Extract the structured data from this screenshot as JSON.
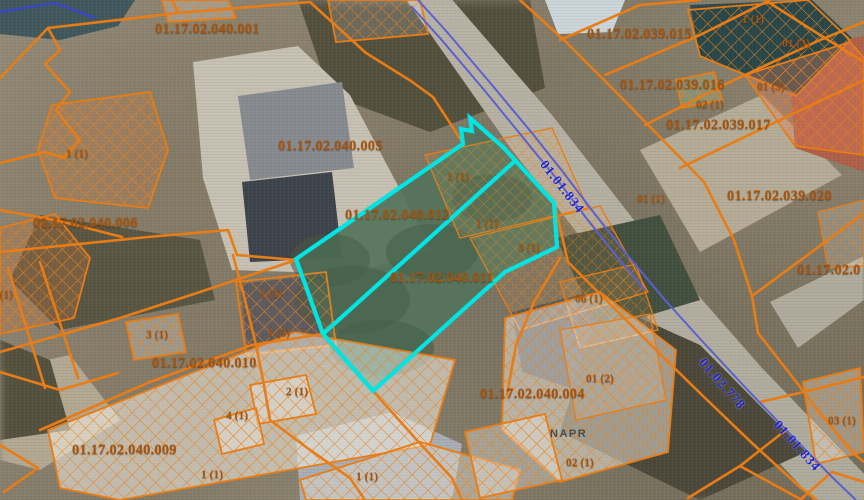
{
  "map": {
    "colors": {
      "parcel_line": "#e87c15",
      "parcel_label": "#a5540e",
      "highlight": "#00e4e4",
      "road_line": "#5c60cf",
      "road_label": "#2326c8"
    },
    "parcel_labels": [
      {
        "text": "01.17.02.040.001",
        "x": 155,
        "y": 21
      },
      {
        "text": "01.17.02.039.015",
        "x": 587,
        "y": 26
      },
      {
        "text": "01.17.02.039.016",
        "x": 620,
        "y": 77
      },
      {
        "text": "01.17.02.039.017",
        "x": 666,
        "y": 117
      },
      {
        "text": "01.17.02.040.005",
        "x": 278,
        "y": 138
      },
      {
        "text": "01.17.02.039.020",
        "x": 727,
        "y": 188
      },
      {
        "text": "01.17.02.040.006",
        "x": 33,
        "y": 215
      },
      {
        "text": "01.17.02.040.012",
        "x": 345,
        "y": 207
      },
      {
        "text": "01.17.02.0",
        "x": 797,
        "y": 262
      },
      {
        "text": "01.17.02.040.011",
        "x": 390,
        "y": 270
      },
      {
        "text": "01.17.02.040.010",
        "x": 152,
        "y": 355
      },
      {
        "text": "01.17.02.040.009",
        "x": 72,
        "y": 442
      },
      {
        "text": "01.17.02.040.004",
        "x": 480,
        "y": 386
      }
    ],
    "unit_labels": [
      {
        "text": "1 (1)",
        "x": 742,
        "y": 14
      },
      {
        "text": "01 (3)",
        "x": 782,
        "y": 38
      },
      {
        "text": "01 (3)",
        "x": 757,
        "y": 81
      },
      {
        "text": "02 (1)",
        "x": 696,
        "y": 99
      },
      {
        "text": "1 (1)",
        "x": 66,
        "y": 148
      },
      {
        "text": "1 (1)",
        "x": 447,
        "y": 171
      },
      {
        "text": "01 (1)",
        "x": 637,
        "y": 193
      },
      {
        "text": "1 (1)",
        "x": 476,
        "y": 218
      },
      {
        "text": "3 (1)",
        "x": 518,
        "y": 242
      },
      {
        "text": "1 (1)",
        "x": -9,
        "y": 289
      },
      {
        "text": "1 (1)",
        "x": 260,
        "y": 288
      },
      {
        "text": "06 (1)",
        "x": 575,
        "y": 293
      },
      {
        "text": "3 (1)",
        "x": 146,
        "y": 329
      },
      {
        "text": "1 (1)",
        "x": 268,
        "y": 327
      },
      {
        "text": "01 (2)",
        "x": 586,
        "y": 373
      },
      {
        "text": "2 (1)",
        "x": 286,
        "y": 386
      },
      {
        "text": "4 (1)",
        "x": 226,
        "y": 410
      },
      {
        "text": "03 (1)",
        "x": 828,
        "y": 415
      },
      {
        "text": "02 (1)",
        "x": 566,
        "y": 457
      },
      {
        "text": "1 (1)",
        "x": 201,
        "y": 469
      },
      {
        "text": "1 (1)",
        "x": 356,
        "y": 471
      }
    ],
    "road_labels": [
      {
        "text": "01.01.834",
        "x": 562,
        "y": 187,
        "angle": 52
      },
      {
        "text": "01.02.778",
        "x": 722,
        "y": 384,
        "angle": 49
      },
      {
        "text": "01.01.834",
        "x": 797,
        "y": 446,
        "angle": 48
      }
    ],
    "street_label": {
      "text": "NAPR",
      "x": 550,
      "y": 428
    }
  },
  "geometry": {
    "highlight": {
      "outer": "470,118 472,131 461,129 463,144 296,259 323,334 373,391 505,272 557,247 554,203 503,147",
      "divider": "516,160 323,334"
    },
    "vegetation": "470,118 472,131 461,129 463,144 296,259 323,334 373,391 505,272 557,247 554,203 503,147",
    "veg_blobs": [
      [
        352,
        300,
        58,
        34
      ],
      [
        432,
        252,
        46,
        28
      ],
      [
        492,
        198,
        40,
        24
      ],
      [
        382,
        348,
        52,
        28
      ],
      [
        330,
        260,
        40,
        26
      ]
    ],
    "orange_lines": [
      "0,78 48,28 178,13 310,2 366,53 411,81 433,97 463,143",
      "48,28 60,50 45,64 70,92 56,110 80,140 64,158 45,152",
      "0,163 45,152",
      "178,13 172,0",
      "0,252 148,237 228,230 237,255 296,260",
      "0,210 60,221 122,237",
      "296,260 200,292 120,318 0,352",
      "40,430 150,382 252,345 323,334",
      "233,255 245,300 256,345 264,385 270,420",
      "0,372 60,390 118,373",
      "8,268 45,388",
      "40,262 78,378",
      "373,391 415,438 452,478 462,500",
      "270,420 310,450 350,478 365,500",
      "560,258 534,302 516,345 507,395",
      "556,210 568,262 612,306 657,351 703,396 753,444 801,488 817,500",
      "520,0 566,42 612,88 658,135 704,182 734,240 752,296 758,333 787,370 820,413 853,453 864,462",
      "560,40 640,5 700,0",
      "605,75 700,35 770,0",
      "645,125 730,82 820,40 864,22",
      "680,168 780,120 864,80",
      "752,296 863,214",
      "760,402 808,391 864,377",
      "688,498 740,466 802,500",
      "740,466 786,430",
      "765,0 820,35 864,62",
      "800,500 832,472 864,482",
      "0,445 38,468 4,492"
    ],
    "buildings": [
      {
        "pts": "52,105 150,92 168,150 148,208 55,198 38,150",
        "tint": "rgba(205,130,70,0.28)"
      },
      {
        "pts": "162,0 228,0 236,18 168,22",
        "tint": "rgba(255,255,255,0.2)"
      },
      {
        "pts": "328,0 420,0 428,34 336,42",
        "tint": "rgba(255,255,255,0.15)"
      },
      {
        "pts": "0,228 55,214 90,258 74,318 0,334",
        "tint": "rgba(195,115,60,0.3)"
      },
      {
        "pts": "126,322 178,314 186,352 134,360",
        "tint": "rgba(255,255,255,0.22)"
      },
      {
        "pts": "236,282 326,272 336,345 246,355",
        "tint": "rgba(120,90,70,0.18)"
      },
      {
        "pts": "48,430 295,332 455,360 430,445 120,500 60,488",
        "tint": "rgba(244,240,230,0.55)"
      },
      {
        "pts": "250,385 306,375 316,414 258,424",
        "tint": "rgba(255,255,255,0.3)"
      },
      {
        "pts": "214,420 256,408 264,444 222,454",
        "tint": "rgba(255,255,255,0.3)"
      },
      {
        "pts": "300,480 420,442 520,470 512,500 306,500",
        "tint": "rgba(235,230,218,0.4)"
      },
      {
        "pts": "425,155 552,128 588,208 460,238",
        "tint": "rgba(235,170,90,0.1)",
        "thin": true
      },
      {
        "pts": "470,238 600,206 648,292 520,330",
        "tint": "rgba(235,170,90,0.1)",
        "thin": true
      },
      {
        "pts": "560,282 636,264 658,330 580,348",
        "tint": "rgba(235,170,90,0.12)",
        "thin": true
      },
      {
        "pts": "505,318 600,292 676,350 668,452 560,482 502,430",
        "tint": "rgba(242,238,228,0.5)"
      },
      {
        "pts": "465,432 545,414 562,480 480,498",
        "tint": "rgba(255,255,255,0.3)"
      },
      {
        "pts": "688,10 808,0 850,40 796,96 700,56",
        "tint": "rgba(25,65,65,0.3)"
      },
      {
        "pts": "745,75 850,42 864,58 864,155 795,146",
        "tint": "rgba(220,125,95,0.35)"
      },
      {
        "pts": "676,80 714,72 722,100 682,108",
        "tint": "rgba(150,200,150,0.3)"
      },
      {
        "pts": "818,212 864,200 864,266 828,268",
        "tint": "rgba(255,255,255,0.15)",
        "thin": true
      },
      {
        "pts": "803,382 860,368 864,452 816,464",
        "tint": "rgba(235,225,215,0.35)"
      },
      {
        "pts": "560,330 650,314 666,400 576,420",
        "tint": "rgba(255,255,255,0.12)",
        "thin": true
      }
    ],
    "blue_lines": [
      {
        "pts": "418,0 447,32 492,85 532,133 563,172 594,213 628,256 665,300 703,342 743,385 788,432 833,478 856,500",
        "w": 2
      },
      {
        "pts": "411,6 440,38 485,91 525,140 556,178 587,219 618,258 645,290",
        "w": 2
      },
      {
        "pts": "0,12 55,3 95,18",
        "w": 2.4,
        "c": "#3a46c4"
      }
    ]
  }
}
